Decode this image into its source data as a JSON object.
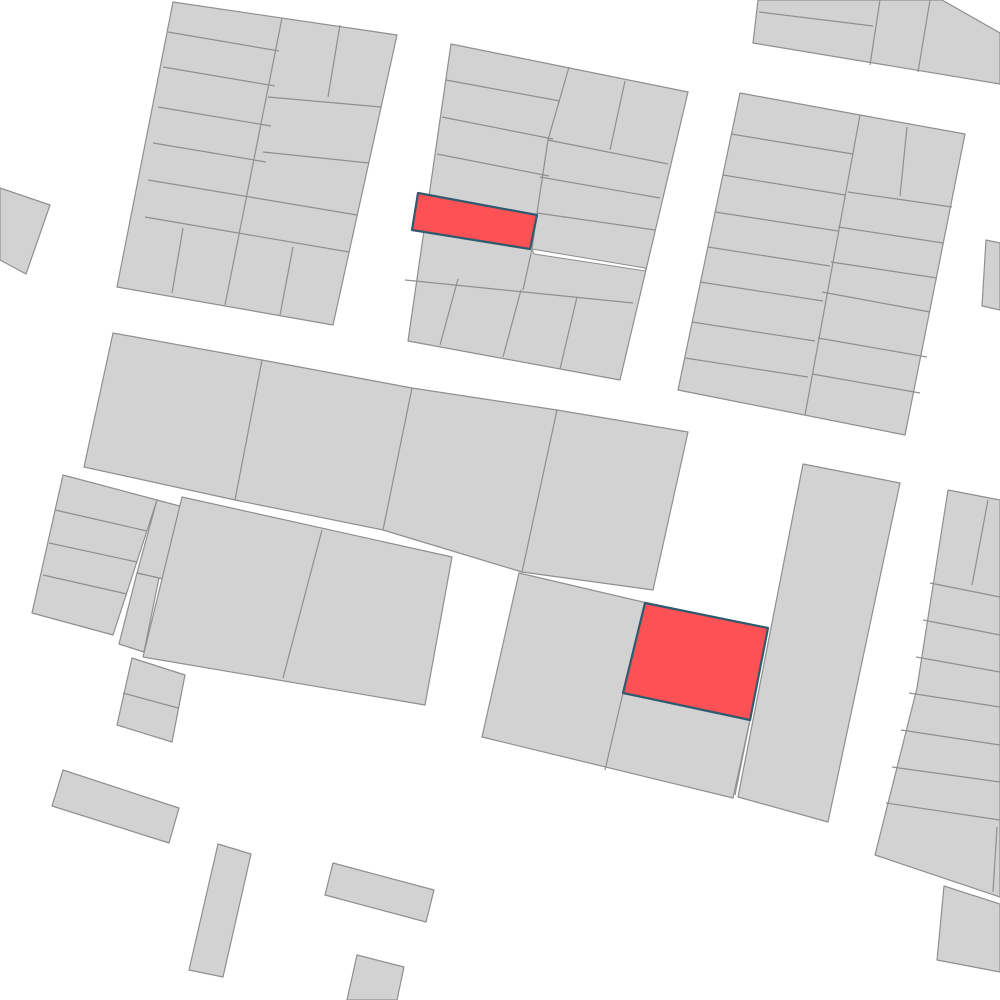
{
  "map": {
    "viewbox": "0 0 1000 1000",
    "background_color": "#ffffff",
    "parcel_fill": "#d2d2d2",
    "parcel_stroke": "#8f8f8f",
    "parcel_stroke_width": 1.2,
    "highlight_fill": "#fc5256",
    "highlight_stroke": "#2e5b6e",
    "highlight_stroke_width": 2.2,
    "gap_fill": "#ffffff",
    "blocks": [
      {
        "name": "block-top-left",
        "outline": [
          [
            173,
            2
          ],
          [
            397,
            35
          ],
          [
            333,
            325
          ],
          [
            117,
            287
          ]
        ],
        "lines": [
          [
            [
              168,
              32
            ],
            [
              279,
              51
            ]
          ],
          [
            [
              163,
              67
            ],
            [
              275,
              86
            ]
          ],
          [
            [
              158,
              107
            ],
            [
              271,
              126
            ]
          ],
          [
            [
              153,
              143
            ],
            [
              266,
              162
            ]
          ],
          [
            [
              148,
              180
            ],
            [
              357,
              215
            ]
          ],
          [
            [
              145,
              217
            ],
            [
              349,
              252
            ]
          ],
          [
            [
              282,
              18
            ],
            [
              225,
              305
            ]
          ],
          [
            [
              183,
              228
            ],
            [
              172,
              293
            ]
          ],
          [
            [
              293,
              247
            ],
            [
              280,
              315
            ]
          ],
          [
            [
              340,
              25
            ],
            [
              328,
              97
            ]
          ],
          [
            [
              268,
              97
            ],
            [
              381,
              107
            ]
          ],
          [
            [
              263,
              152
            ],
            [
              369,
              163
            ]
          ]
        ]
      },
      {
        "name": "block-top-middle",
        "outline": [
          [
            451,
            44
          ],
          [
            688,
            92
          ],
          [
            620,
            380
          ],
          [
            408,
            341
          ]
        ],
        "lines": [
          [
            [
              569,
              67
            ],
            [
              548,
              140
            ],
            [
              537,
              213
            ],
            [
              532,
              249
            ],
            [
              523,
              290
            ]
          ],
          [
            [
              446,
              80
            ],
            [
              560,
              101
            ]
          ],
          [
            [
              442,
              117
            ],
            [
              553,
              139
            ]
          ],
          [
            [
              437,
              154
            ],
            [
              549,
              176
            ]
          ],
          [
            [
              405,
              280
            ],
            [
              633,
              303
            ]
          ],
          [
            [
              548,
              140
            ],
            [
              668,
              164
            ]
          ],
          [
            [
              540,
              177
            ],
            [
              660,
              198
            ]
          ],
          [
            [
              537,
              213
            ],
            [
              655,
              230
            ]
          ],
          [
            [
              625,
              81
            ],
            [
              610,
              150
            ]
          ],
          [
            [
              458,
              279
            ],
            [
              440,
              345
            ]
          ],
          [
            [
              521,
              290
            ],
            [
              503,
              357
            ]
          ],
          [
            [
              577,
              297
            ],
            [
              560,
              369
            ]
          ]
        ]
      },
      {
        "name": "block-top-right-corner",
        "outline": [
          [
            753,
            43
          ],
          [
            758,
            0
          ],
          [
            942,
            0
          ],
          [
            1000,
            33
          ],
          [
            1000,
            84
          ]
        ],
        "lines": [
          [
            [
              759,
              12
            ],
            [
              873,
              26
            ]
          ],
          [
            [
              880,
              0
            ],
            [
              870,
              65
            ]
          ],
          [
            [
              930,
              0
            ],
            [
              918,
              72
            ]
          ]
        ]
      },
      {
        "name": "block-top-right",
        "outline": [
          [
            740,
            93
          ],
          [
            860,
            115
          ],
          [
            965,
            134
          ],
          [
            905,
            435
          ],
          [
            678,
            390
          ]
        ],
        "lines": [
          [
            [
              860,
              115
            ],
            [
              805,
              415
            ]
          ],
          [
            [
              731,
              134
            ],
            [
              853,
              154
            ]
          ],
          [
            [
              723,
              175
            ],
            [
              845,
              195
            ]
          ],
          [
            [
              715,
              212
            ],
            [
              838,
              231
            ]
          ],
          [
            [
              708,
              247
            ],
            [
              830,
              266
            ]
          ],
          [
            [
              700,
              282
            ],
            [
              823,
              301
            ]
          ],
          [
            [
              692,
              322
            ],
            [
              815,
              341
            ]
          ],
          [
            [
              685,
              358
            ],
            [
              808,
              377
            ]
          ],
          [
            [
              907,
              127
            ],
            [
              900,
              196
            ]
          ],
          [
            [
              848,
              192
            ],
            [
              952,
              207
            ]
          ],
          [
            [
              838,
              227
            ],
            [
              943,
              243
            ]
          ],
          [
            [
              831,
              262
            ],
            [
              937,
              278
            ]
          ],
          [
            [
              822,
              292
            ],
            [
              930,
              312
            ]
          ],
          [
            [
              818,
              338
            ],
            [
              927,
              357
            ]
          ],
          [
            [
              812,
              374
            ],
            [
              920,
              393
            ]
          ]
        ]
      },
      {
        "name": "parcel-right-edge-sliver",
        "outline": [
          [
            986,
            240
          ],
          [
            1000,
            243
          ],
          [
            1000,
            310
          ],
          [
            982,
            306
          ]
        ],
        "lines": []
      },
      {
        "name": "parcel-left-edge",
        "outline": [
          [
            0,
            188
          ],
          [
            50,
            205
          ],
          [
            26,
            274
          ],
          [
            0,
            260
          ]
        ],
        "lines": []
      },
      {
        "name": "block-middle-wide",
        "outline": [
          [
            113,
            333
          ],
          [
            262,
            360
          ],
          [
            412,
            388
          ],
          [
            557,
            410
          ],
          [
            688,
            432
          ],
          [
            653,
            590
          ],
          [
            522,
            572
          ],
          [
            383,
            530
          ],
          [
            235,
            500
          ],
          [
            84,
            467
          ]
        ],
        "lines": [
          [
            [
              262,
              360
            ],
            [
              235,
              500
            ]
          ],
          [
            [
              412,
              388
            ],
            [
              383,
              530
            ]
          ],
          [
            [
              557,
              410
            ],
            [
              522,
              572
            ]
          ]
        ]
      },
      {
        "name": "block-left-strips",
        "outline": [
          [
            63,
            475
          ],
          [
            157,
            500
          ],
          [
            113,
            635
          ],
          [
            32,
            613
          ]
        ],
        "lines": [
          [
            [
              55,
              510
            ],
            [
              147,
              531
            ]
          ],
          [
            [
              49,
              543
            ],
            [
              137,
              562
            ]
          ],
          [
            [
              43,
              575
            ],
            [
              127,
              594
            ]
          ]
        ]
      },
      {
        "name": "parcel-protruding",
        "outline": [
          [
            157,
            500
          ],
          [
            202,
            512
          ],
          [
            180,
            583
          ],
          [
            137,
            573
          ]
        ],
        "lines": []
      },
      {
        "name": "parcel-narrow-tall",
        "outline": [
          [
            137,
            573
          ],
          [
            159,
            578
          ],
          [
            144,
            652
          ],
          [
            119,
            644
          ]
        ],
        "lines": []
      },
      {
        "name": "block-left-main",
        "outline": [
          [
            182,
            497
          ],
          [
            452,
            557
          ],
          [
            425,
            705
          ],
          [
            143,
            657
          ]
        ],
        "lines": [
          [
            [
              322,
              530
            ],
            [
              283,
              678
            ]
          ]
        ]
      },
      {
        "name": "block-small-pair",
        "outline": [
          [
            132,
            658
          ],
          [
            185,
            675
          ],
          [
            172,
            742
          ],
          [
            117,
            725
          ]
        ],
        "lines": [
          [
            [
              123,
              693
            ],
            [
              178,
              708
            ]
          ]
        ]
      },
      {
        "name": "block-lower-middle",
        "outline": [
          [
            519,
            573
          ],
          [
            643,
            602
          ],
          [
            768,
            628
          ],
          [
            750,
            720
          ],
          [
            733,
            798
          ],
          [
            482,
            737
          ]
        ],
        "lines": [
          [
            [
              645,
              603
            ],
            [
              623,
              693
            ],
            [
              605,
              770
            ]
          ],
          [
            [
              750,
              720
            ],
            [
              735,
              795
            ]
          ]
        ]
      },
      {
        "name": "block-tall-column",
        "outline": [
          [
            803,
            464
          ],
          [
            900,
            483
          ],
          [
            828,
            822
          ],
          [
            738,
            797
          ]
        ],
        "lines": []
      },
      {
        "name": "block-right-strips",
        "outline": [
          [
            948,
            490
          ],
          [
            1000,
            500
          ],
          [
            1000,
            897
          ],
          [
            875,
            855
          ],
          [
            917,
            688
          ]
        ],
        "lines": [
          [
            [
              988,
              500
            ],
            [
              972,
              585
            ]
          ],
          [
            [
              930,
              583
            ],
            [
              1000,
              597
            ]
          ],
          [
            [
              923,
              620
            ],
            [
              1000,
              635
            ]
          ],
          [
            [
              916,
              657
            ],
            [
              1000,
              672
            ]
          ],
          [
            [
              909,
              693
            ],
            [
              1000,
              707
            ]
          ],
          [
            [
              901,
              730
            ],
            [
              1000,
              745
            ]
          ],
          [
            [
              892,
              767
            ],
            [
              1000,
              782
            ]
          ],
          [
            [
              886,
              803
            ],
            [
              1000,
              820
            ]
          ],
          [
            [
              997,
              827
            ],
            [
              993,
              892
            ]
          ]
        ]
      },
      {
        "name": "block-bottom-right-corner",
        "outline": [
          [
            944,
            886
          ],
          [
            1000,
            904
          ],
          [
            1000,
            972
          ],
          [
            937,
            960
          ]
        ],
        "lines": []
      },
      {
        "name": "parcel-small-horizontal-1",
        "outline": [
          [
            63,
            770
          ],
          [
            179,
            808
          ],
          [
            169,
            843
          ],
          [
            52,
            806
          ]
        ],
        "lines": []
      },
      {
        "name": "parcel-small-vertical",
        "outline": [
          [
            218,
            844
          ],
          [
            251,
            854
          ],
          [
            223,
            977
          ],
          [
            189,
            970
          ]
        ],
        "lines": []
      },
      {
        "name": "parcel-small-horizontal-2",
        "outline": [
          [
            333,
            863
          ],
          [
            434,
            890
          ],
          [
            426,
            922
          ],
          [
            325,
            895
          ]
        ],
        "lines": []
      },
      {
        "name": "parcel-small-bottom-edge",
        "outline": [
          [
            357,
            955
          ],
          [
            404,
            967
          ],
          [
            397,
            1000
          ],
          [
            347,
            1000
          ]
        ],
        "lines": []
      }
    ],
    "gaps": [
      {
        "name": "gap-sliver-top-middle",
        "points": [
          [
            532,
            249
          ],
          [
            645,
            268
          ],
          [
            646,
            271
          ],
          [
            534,
            254
          ]
        ]
      }
    ],
    "highlights": [
      {
        "name": "highlighted-parcel-1",
        "points": [
          [
            418,
            193
          ],
          [
            537,
            215
          ],
          [
            530,
            249
          ],
          [
            412,
            230
          ]
        ]
      },
      {
        "name": "highlighted-parcel-2",
        "points": [
          [
            645,
            603
          ],
          [
            768,
            628
          ],
          [
            750,
            720
          ],
          [
            623,
            693
          ]
        ]
      }
    ]
  }
}
